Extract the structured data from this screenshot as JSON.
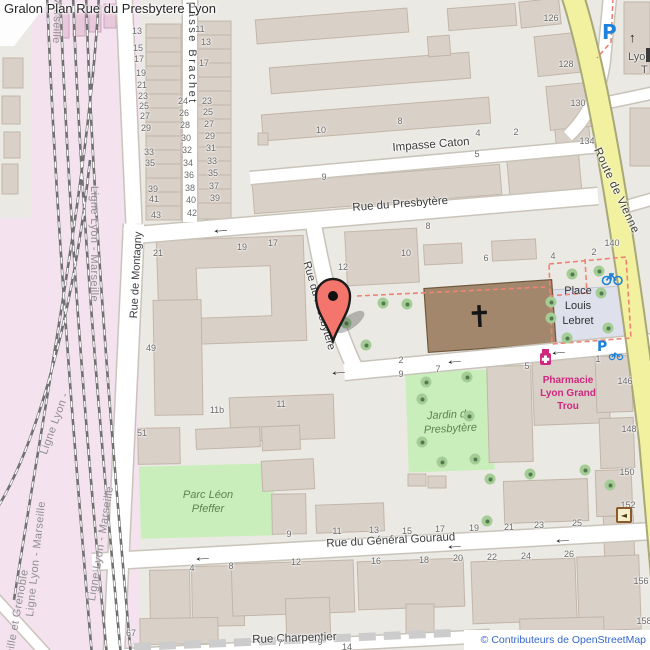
{
  "title": "Gralon Plan Rue du Presbytere Lyon",
  "attribution": "© Contributeurs de OpenStreetMap",
  "colors": {
    "building": "#d9d0c8",
    "church_brown": "#a3876c",
    "road_yellow": "#f1f1a0",
    "railway_pink": "#f4e2ef",
    "park_green": "#c9eebb",
    "pedestrian_area": "#dee0ec",
    "marker_red": "#f4756b",
    "pharmacy_magenta": "#d0287e",
    "transport_blue": "#1e82dc",
    "attribution_blue": "#3566cc",
    "dashed_red": "#ef8372"
  },
  "streets": [
    {
      "text": "Impasse Caton",
      "x": 392,
      "y": 142,
      "rot": -4.5,
      "size": 11.5
    },
    {
      "text": "Rue du Presbytère",
      "x": 352,
      "y": 202,
      "rot": -4.3,
      "size": 11.5
    },
    {
      "text": "Rue du Presbytère",
      "x": 312,
      "y": 260,
      "rot": 74,
      "size": 11
    },
    {
      "text": "Rue de Montagny",
      "x": 128,
      "y": 318,
      "rot": -87,
      "size": 11
    },
    {
      "text": "passe Brachet",
      "x": 198,
      "y": 2,
      "rot": 90,
      "size": 11,
      "ls": 2.5
    },
    {
      "text": "Route de Vienne",
      "x": 602,
      "y": 146,
      "rot": 65,
      "size": 11.5,
      "ls": 0.5
    },
    {
      "text": "Rue du Général Gouraud",
      "x": 326,
      "y": 538,
      "rot": -3,
      "size": 11.5
    },
    {
      "text": "Rue Charpentier",
      "x": 252,
      "y": 634,
      "rot": -2,
      "size": 11.5
    }
  ],
  "railways": [
    {
      "text": "Ligne Lyon - Marseille",
      "x": 66,
      "y": -72,
      "rot": 92
    },
    {
      "text": "Ligne Lyon - Marseille",
      "x": 100,
      "y": 186,
      "rot": 90
    },
    {
      "text": "Ligne Lyon - Marseille",
      "x": 24,
      "y": 616,
      "rot": -84
    },
    {
      "text": "Ligne Lyon - Marseille",
      "x": 86,
      "y": 600,
      "rot": -81
    },
    {
      "text": "Ligne Lyon -",
      "x": 38,
      "y": 452,
      "rot": -70
    },
    {
      "text": "eille et Grenoble",
      "x": 4,
      "y": 654,
      "rot": -80
    }
  ],
  "area_labels": [
    {
      "cls": "park-l",
      "name": "parc-leon-pfeffer-label",
      "lines": [
        "Parc Léon",
        "Pfeffer"
      ],
      "x": 158,
      "y": 488,
      "w": 100,
      "rot": 0
    },
    {
      "cls": "park-l",
      "name": "jardin-du-presbytere-label",
      "lines": [
        "Jardin du",
        "Presbytère"
      ],
      "x": 406,
      "y": 408,
      "w": 88,
      "rot": -3
    },
    {
      "cls": "place-l",
      "name": "place-louis-lebret-label",
      "lines": [
        "Place",
        "Louis",
        "Lebret"
      ],
      "x": 546,
      "y": 284,
      "w": 64,
      "rot": 0
    },
    {
      "cls": "pharm-l",
      "name": "pharmacie-label",
      "lines": [
        "Pharmacie",
        "Lyon Grand",
        "Trou"
      ],
      "x": 526,
      "y": 374,
      "w": 84,
      "rot": 0
    }
  ],
  "transit": {
    "parking": "P",
    "stop_line1": "Lyon",
    "stop_line2": "T",
    "church_cross": "✝",
    "poi_glyph": "◄"
  },
  "house_numbers": [
    [
      "13",
      137,
      31
    ],
    [
      "15",
      138,
      48
    ],
    [
      "17",
      139,
      59
    ],
    [
      "19",
      141,
      73
    ],
    [
      "21",
      142,
      85
    ],
    [
      "23",
      143,
      96
    ],
    [
      "25",
      144,
      106
    ],
    [
      "27",
      145,
      116
    ],
    [
      "29",
      146,
      128
    ],
    [
      "33",
      149,
      152
    ],
    [
      "35",
      150,
      163
    ],
    [
      "39",
      153,
      189
    ],
    [
      "41",
      154,
      199
    ],
    [
      "43",
      156,
      215
    ],
    [
      "24",
      183,
      101
    ],
    [
      "26",
      184,
      113
    ],
    [
      "28",
      185,
      125
    ],
    [
      "30",
      186,
      138
    ],
    [
      "32",
      187,
      150
    ],
    [
      "34",
      188,
      163
    ],
    [
      "36",
      189,
      175
    ],
    [
      "38",
      190,
      188
    ],
    [
      "40",
      191,
      200
    ],
    [
      "42",
      192,
      213
    ],
    [
      "11",
      200,
      29
    ],
    [
      "13",
      206,
      42
    ],
    [
      "17",
      204,
      63
    ],
    [
      "23",
      207,
      101
    ],
    [
      "25",
      208,
      112
    ],
    [
      "27",
      209,
      124
    ],
    [
      "29",
      210,
      136
    ],
    [
      "31",
      211,
      148
    ],
    [
      "33",
      212,
      161
    ],
    [
      "35",
      213,
      173
    ],
    [
      "37",
      214,
      186
    ],
    [
      "39",
      215,
      198
    ],
    [
      "10",
      321,
      130
    ],
    [
      "9",
      324,
      177
    ],
    [
      "8",
      400,
      121
    ],
    [
      "4",
      478,
      133
    ],
    [
      "2",
      516,
      132
    ],
    [
      "5",
      477,
      154
    ],
    [
      "8",
      428,
      226
    ],
    [
      "12",
      343,
      267
    ],
    [
      "10",
      406,
      253
    ],
    [
      "6",
      486,
      258
    ],
    [
      "4",
      553,
      256
    ],
    [
      "2",
      594,
      252
    ],
    [
      "126",
      551,
      18
    ],
    [
      "128",
      566,
      64
    ],
    [
      "130",
      578,
      103
    ],
    [
      "134",
      587,
      141
    ],
    [
      "140",
      612,
      243
    ],
    [
      "146",
      625,
      381
    ],
    [
      "148",
      629,
      429
    ],
    [
      "150",
      627,
      472
    ],
    [
      "152",
      628,
      505
    ],
    [
      "156",
      641,
      581
    ],
    [
      "158",
      644,
      621
    ],
    [
      "21",
      158,
      253
    ],
    [
      "19",
      242,
      247
    ],
    [
      "17",
      273,
      243
    ],
    [
      "49",
      151,
      348
    ],
    [
      "11b",
      217,
      410
    ],
    [
      "11",
      281,
      404
    ],
    [
      "51",
      142,
      433
    ],
    [
      "2",
      401,
      360
    ],
    [
      "9",
      401,
      374
    ],
    [
      "7",
      438,
      369
    ],
    [
      "5",
      527,
      366
    ],
    [
      "1",
      598,
      359
    ],
    [
      "9",
      289,
      534
    ],
    [
      "11",
      337,
      531
    ],
    [
      "13",
      374,
      530
    ],
    [
      "15",
      407,
      531
    ],
    [
      "17",
      440,
      529
    ],
    [
      "19",
      474,
      528
    ],
    [
      "21",
      509,
      527
    ],
    [
      "23",
      539,
      525
    ],
    [
      "25",
      577,
      523
    ],
    [
      "4",
      192,
      568
    ],
    [
      "8",
      231,
      566
    ],
    [
      "12",
      296,
      562
    ],
    [
      "16",
      376,
      561
    ],
    [
      "18",
      424,
      560
    ],
    [
      "20",
      458,
      558
    ],
    [
      "22",
      492,
      557
    ],
    [
      "24",
      526,
      556
    ],
    [
      "26",
      569,
      554
    ],
    [
      "67",
      131,
      633
    ],
    [
      "7",
      280,
      643
    ],
    [
      "9",
      320,
      642
    ],
    [
      "14",
      347,
      647
    ]
  ],
  "trees": [
    [
      383,
      303
    ],
    [
      407,
      304
    ],
    [
      346,
      323
    ],
    [
      366,
      345
    ],
    [
      572,
      274
    ],
    [
      599,
      271
    ],
    [
      551,
      302
    ],
    [
      551,
      318
    ],
    [
      601,
      293
    ],
    [
      608,
      328
    ],
    [
      567,
      338
    ],
    [
      426,
      382
    ],
    [
      467,
      377
    ],
    [
      422,
      399
    ],
    [
      469,
      416
    ],
    [
      422,
      442
    ],
    [
      442,
      462
    ],
    [
      475,
      459
    ],
    [
      490,
      479
    ],
    [
      530,
      474
    ],
    [
      585,
      470
    ],
    [
      610,
      485
    ],
    [
      487,
      521
    ]
  ],
  "arrows": [
    {
      "g": "←",
      "x": 214,
      "y": 221,
      "r": -4
    },
    {
      "g": "←",
      "x": 332,
      "y": 363,
      "r": -5
    },
    {
      "g": "←",
      "x": 448,
      "y": 352,
      "r": -5
    },
    {
      "g": "←",
      "x": 552,
      "y": 343,
      "r": -5
    },
    {
      "g": "←",
      "x": 196,
      "y": 549,
      "r": -3
    },
    {
      "g": "←",
      "x": 448,
      "y": 537,
      "r": -3
    },
    {
      "g": "←",
      "x": 556,
      "y": 531,
      "r": -3
    },
    {
      "g": "↑",
      "x": 629,
      "y": 30,
      "r": 0
    }
  ]
}
